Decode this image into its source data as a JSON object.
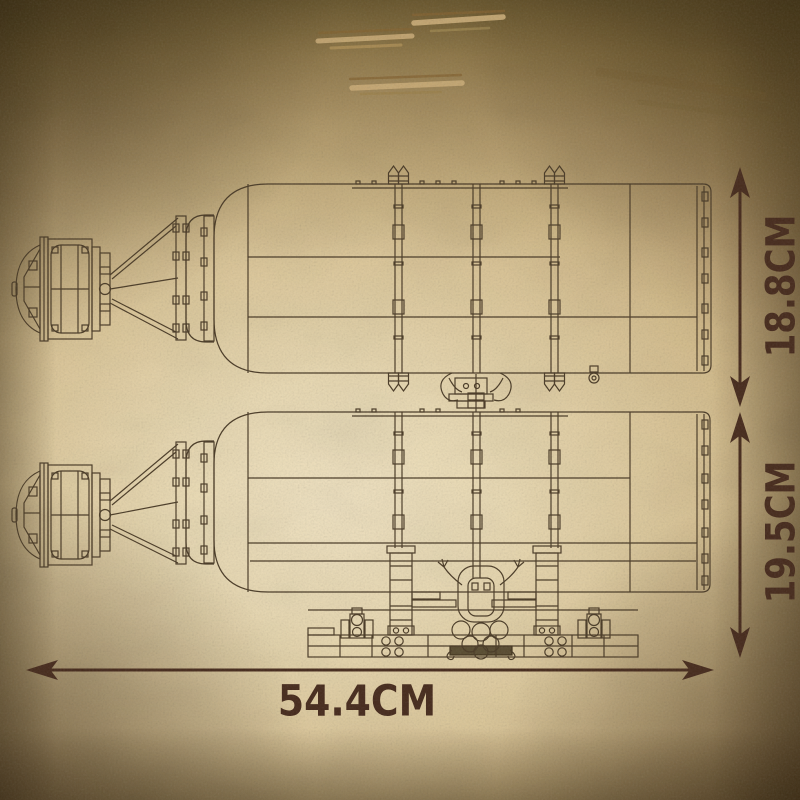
{
  "page": {
    "kind": "product-dimension-diagram",
    "style": "vintage-parchment-blueprint"
  },
  "annotations": {
    "height_top_view": "18.8CM",
    "height_side_view": "19.5CM",
    "overall_width": "54.4CM"
  },
  "views": [
    {
      "name": "bottle-top-view"
    },
    {
      "name": "bottle-side-view-with-stand"
    }
  ],
  "colors": {
    "ink": "#4a3a24",
    "annotation": "#46291a",
    "paper_center": "#f2e4c2",
    "paper_edge": "#55400f"
  }
}
